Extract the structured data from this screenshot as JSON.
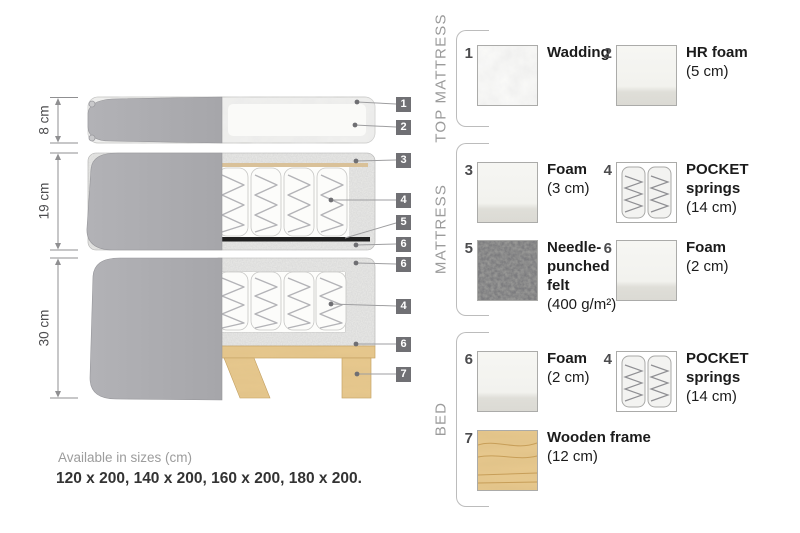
{
  "diagram": {
    "dimension_labels": [
      "8 cm",
      "19 cm",
      "30 cm"
    ],
    "callout_numbers": [
      "1",
      "2",
      "3",
      "4",
      "5",
      "6",
      "6",
      "4",
      "6",
      "7"
    ]
  },
  "legend": {
    "sections": [
      {
        "title": "TOP MATTRESS",
        "items": [
          {
            "number": "1",
            "name": "Wadding",
            "size": "",
            "swatch": "wadding"
          },
          {
            "number": "2",
            "name": "HR foam",
            "size": "(5 cm)",
            "swatch": "foam"
          }
        ]
      },
      {
        "title": "MATTRESS",
        "items": [
          {
            "number": "3",
            "name": "Foam",
            "size": "(3 cm)",
            "swatch": "foam"
          },
          {
            "number": "4",
            "name": "POCKET springs",
            "size": "(14 cm)",
            "swatch": "pocket-springs"
          },
          {
            "number": "5",
            "name": "Needle-punched felt",
            "size": "(400 g/m²)",
            "swatch": "felt"
          },
          {
            "number": "6",
            "name": "Foam",
            "size": "(2 cm)",
            "swatch": "foam"
          }
        ]
      },
      {
        "title": "BED",
        "items": [
          {
            "number": "6",
            "name": "Foam",
            "size": "(2 cm)",
            "swatch": "foam"
          },
          {
            "number": "4",
            "name": "POCKET springs",
            "size": "(14 cm)",
            "swatch": "pocket-springs"
          },
          {
            "number": "7",
            "name": "Wooden frame",
            "size": "(12 cm)",
            "swatch": "wood"
          }
        ]
      }
    ]
  },
  "footer": {
    "caption": "Available in sizes (cm)",
    "sizes": "120 x 200, 140 x 200, 160 x 200, 180 x 200."
  },
  "colors": {
    "cover_grey": "#ababaf",
    "foam_speckle": "#ebebe9",
    "felt_black": "#1f1f1f",
    "wood_tan": "#e8c98f",
    "callout_bg": "#707074"
  }
}
